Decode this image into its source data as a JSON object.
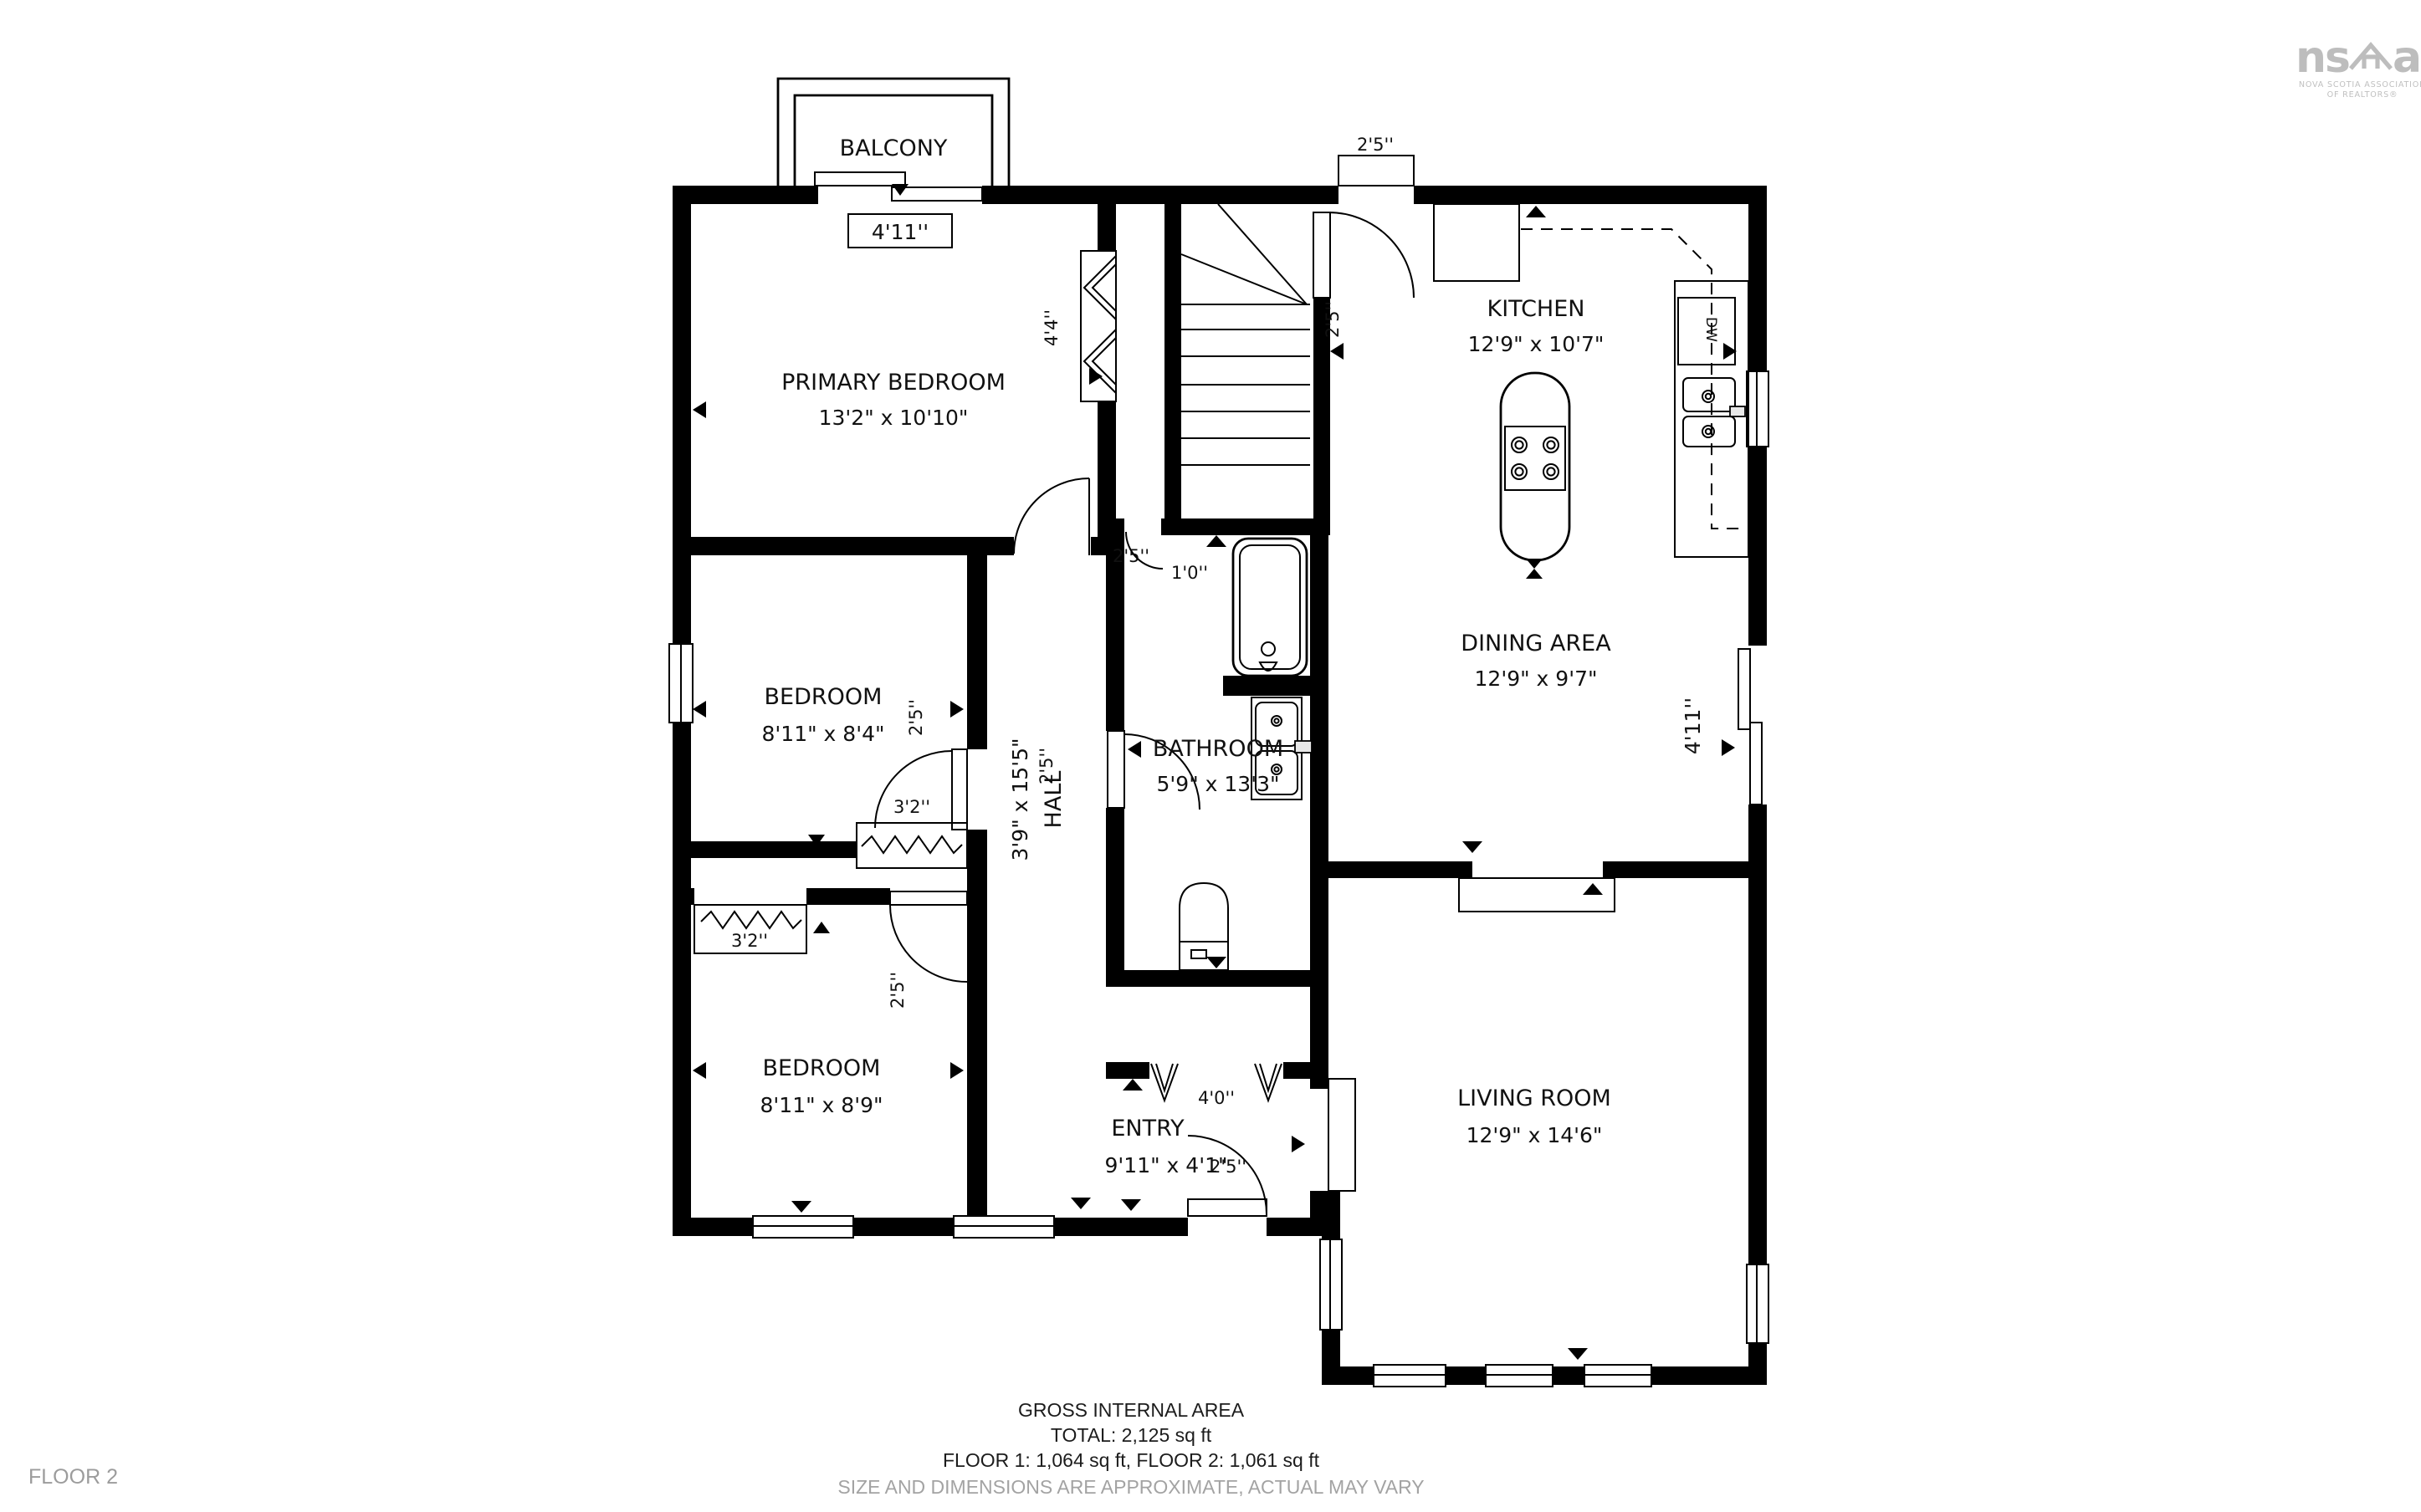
{
  "logo": {
    "mark_left": "ns",
    "mark_right": "aR",
    "tagline_line1": "NOVA SCOTIA ASSOCIATION",
    "tagline_line2": "OF REALTORS®"
  },
  "floor_label": "FLOOR 2",
  "footer": {
    "line1": "GROSS INTERNAL AREA",
    "line2": "TOTAL: 2,125 sq ft",
    "line3": "FLOOR 1: 1,064 sq ft, FLOOR 2: 1,061 sq ft",
    "disclaimer": "SIZE AND DIMENSIONS ARE APPROXIMATE, ACTUAL MAY VARY"
  },
  "rooms": {
    "balcony": {
      "name": "BALCONY"
    },
    "primary_bedroom": {
      "name": "PRIMARY BEDROOM",
      "dims": "13'2\" x 10'10\""
    },
    "bedroom1": {
      "name": "BEDROOM",
      "dims": "8'11\" x 8'4\""
    },
    "bedroom2": {
      "name": "BEDROOM",
      "dims": "8'11\" x 8'9\""
    },
    "hall": {
      "name": "HALL",
      "dims": "3'9\" x 15'5\""
    },
    "bathroom": {
      "name": "BATHROOM",
      "dims": "5'9\" x 13'3\""
    },
    "kitchen": {
      "name": "KITCHEN",
      "dims": "12'9\" x 10'7\""
    },
    "dining": {
      "name": "DINING AREA",
      "dims": "12'9\" x 9'7\""
    },
    "living": {
      "name": "LIVING ROOM",
      "dims": "12'9\" x 14'6\""
    },
    "entry": {
      "name": "ENTRY",
      "dims": "9'11\" x 4'1\""
    }
  },
  "openings": {
    "balcony_slider": "4'11''",
    "kitchen_door": "2'5''",
    "stair_door": "2'5''",
    "primary_closet": "4'4''",
    "primary_door": "2'5''",
    "linen_door": "1'0''",
    "bathroom_door": "2'5''",
    "bedroom1_door": "2'5''",
    "bedroom1_closet": "3'2''",
    "bedroom2_closet": "3'2''",
    "bedroom2_door": "2'5''",
    "entry_closet": "4'0''",
    "entry_door": "2'5''",
    "dining_slider": "4'11''",
    "dishwasher": "DW"
  },
  "colors": {
    "wall": "#000000",
    "muted": "#9c9c9c",
    "logo": "#bdbdbd"
  }
}
